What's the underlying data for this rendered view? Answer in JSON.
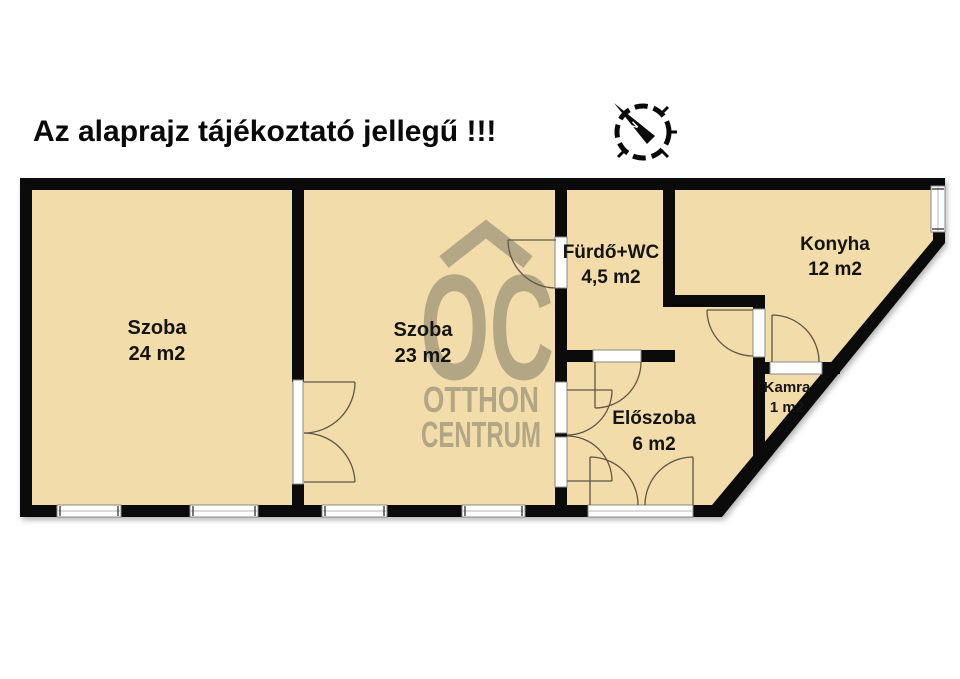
{
  "title": "Az alaprajz tájékoztató jellegű !!!",
  "compass": {
    "north_label": "N"
  },
  "watermark": {
    "monogram": "OC",
    "line1": "OTTHON",
    "line2": "CENTRUM"
  },
  "rooms": {
    "szoba24": {
      "name": "Szoba",
      "area": "24 m2"
    },
    "szoba23": {
      "name": "Szoba",
      "area": "23 m2"
    },
    "furdo_wc": {
      "name": "Fürdő+WC",
      "area": "4,5 m2"
    },
    "konyha": {
      "name": "Konyha",
      "area": "12 m2"
    },
    "eloszoba": {
      "name": "Előszoba",
      "area": "6 m2"
    },
    "kamra": {
      "name": "Kamra",
      "area": "1 m2"
    }
  },
  "colors": {
    "wall": "#0b0b0b",
    "floor": "#f2dcaa",
    "watermark": "#a89d7f",
    "background": "#ffffff",
    "door_line": "#5f5647"
  }
}
